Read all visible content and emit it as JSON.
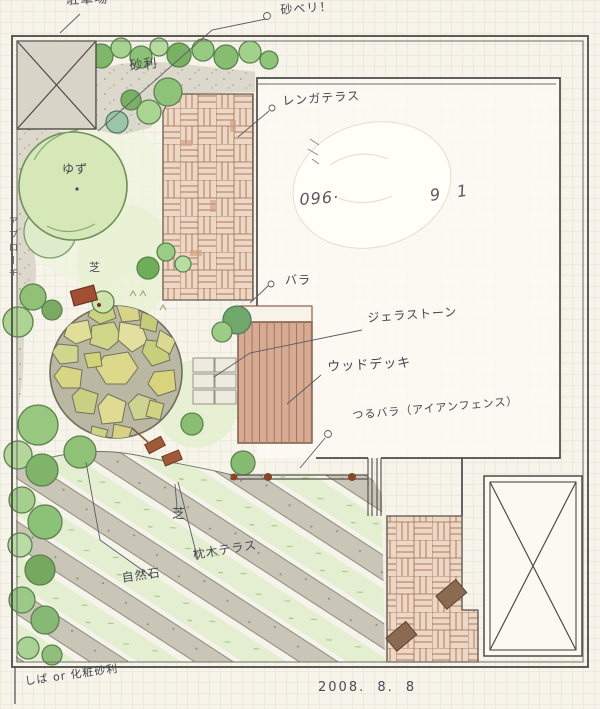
{
  "labels": {
    "parking": "駐車場",
    "edge_note": "砂ベリ！",
    "gravel": "砂利",
    "brick_terrace": "レンガテラス",
    "rose": "バラ",
    "gera_stone": "ジェラストーン",
    "wood_deck": "ウッドデッキ",
    "climbing_rose": "つるバラ（アイアンフェンス）",
    "lawn": "芝",
    "natural_stone": "自然石",
    "sleeper_terrace": "枕木テラス",
    "yuzu_tree": "ゆず",
    "approach": "アプローチ",
    "bottom_note": "しば or 化粧砂利",
    "phone_prefix": "096·",
    "phone_suffix": "9 1",
    "date": "2008.  8.  8"
  },
  "colors": {
    "paper": "#f7f4eb",
    "grid_line": "#edeadc",
    "ink": "#4c4c48",
    "pencil_text": "#45454f",
    "brick": "#b1795c",
    "deck_wood": "#d6ab94",
    "foliage_green": "#8fc177",
    "stone_paving": "#d2d68c",
    "gravel": "#dcd8cc",
    "sleeper_gray": "#c9c6b8",
    "grass_stripe": "#e4efd2",
    "accent_brown": "#9a5b3d"
  }
}
